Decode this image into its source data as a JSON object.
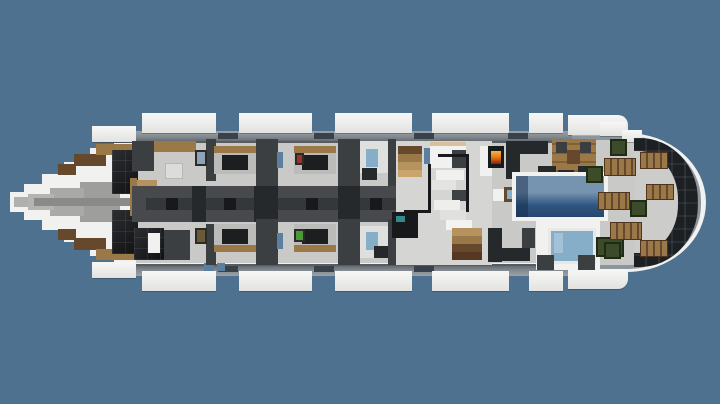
{
  "scene": {
    "type": "game-screenshot",
    "game": "Minecraft",
    "subject": "Yacht interior deck plan, top-down cutaway view",
    "orientation": "bow pointing left, rounded stern at right",
    "visible_text": ""
  },
  "colors": {
    "bg": "#4e7190",
    "hullWhite": "#f1f1ef",
    "floor": "#c9c9c7",
    "floorLight": "#d5d5d3",
    "stripDark": "#565c60",
    "wallDark": "#3c3f42",
    "blockDark": "#26292c",
    "black": "#17191b",
    "corridor": "#47494c",
    "corridorDark": "#35383b",
    "wood": "#9a7848",
    "woodDark": "#66492c",
    "woodLight": "#b6935e",
    "bedFrame": "#bbbbb9",
    "blanket": "#1c1e20",
    "windowBlue": "#5c7f9f",
    "glass": "#86aec9",
    "poolTop": "#7693b0",
    "poolDeep": "#2f5480",
    "poolBand": "#27466b",
    "green": "#3c4c2a",
    "fire": "#e07818",
    "red": "#a03028",
    "teal": "#2e8c8c",
    "paintBlue": "#8fa3b8",
    "paintBrown": "#6a5a3a",
    "paintGreen": "#4a9a3a"
  },
  "inventory": {
    "beds": 4,
    "sun_loungers": 6,
    "planters": 4,
    "balconies_top": 5,
    "balconies_bottom": 5,
    "pools": 1,
    "fireplaces": 1,
    "staircases": 3,
    "paintings": 4
  }
}
